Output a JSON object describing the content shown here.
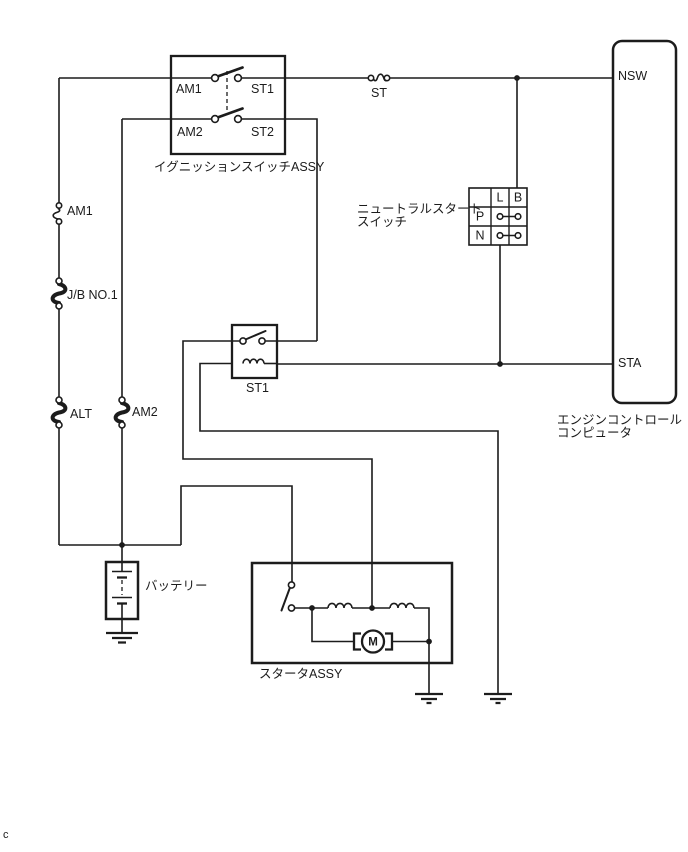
{
  "colors": {
    "line": "#1c1c1c",
    "background": "#ffffff"
  },
  "ignition_switch": {
    "label": "イグニッションスイッチASSY",
    "terminals": {
      "am1": "AM1",
      "st1": "ST1",
      "am2": "AM2",
      "st2": "ST2"
    }
  },
  "fuses": {
    "st": "ST",
    "am1": "AM1",
    "jb_no1": "J/B NO.1",
    "alt": "ALT",
    "am2": "AM2"
  },
  "st1_relay": {
    "label": "ST1"
  },
  "neutral_start_switch": {
    "label_line1": "ニュートラルスタート",
    "label_line2": "スイッチ",
    "columns": [
      "L",
      "B"
    ],
    "rows": [
      "P",
      "N"
    ]
  },
  "engine_control_computer": {
    "label_line1": "エンジンコントロール",
    "label_line2": "コンピュータ",
    "pins": {
      "nsw": "NSW",
      "sta": "STA"
    }
  },
  "battery": {
    "label": "バッテリー"
  },
  "starter_assy": {
    "label": "スタータASSY",
    "motor_letter": "M"
  },
  "footer": {
    "text": "c"
  }
}
